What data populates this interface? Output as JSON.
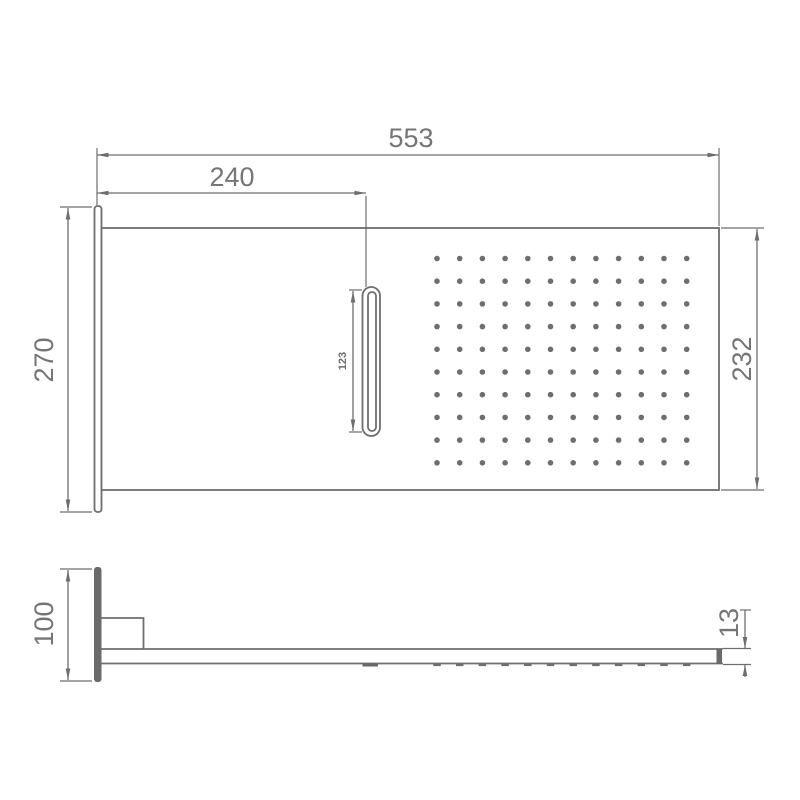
{
  "drawing": {
    "colors": {
      "line": "#6e6e6e",
      "text": "#757575",
      "dark_fill": "#6a6a6a",
      "background": "#ffffff"
    },
    "front_view": {
      "dimensions": {
        "overall_width": "553",
        "slot_offset": "240",
        "plate_height": "270",
        "body_height": "232",
        "slot_length": "123"
      },
      "nozzle_grid": {
        "columns": 12,
        "rows": 10
      }
    },
    "side_view": {
      "dimensions": {
        "plate_height": "100",
        "arm_thickness": "13"
      },
      "nozzle_dash_count": 12
    }
  }
}
